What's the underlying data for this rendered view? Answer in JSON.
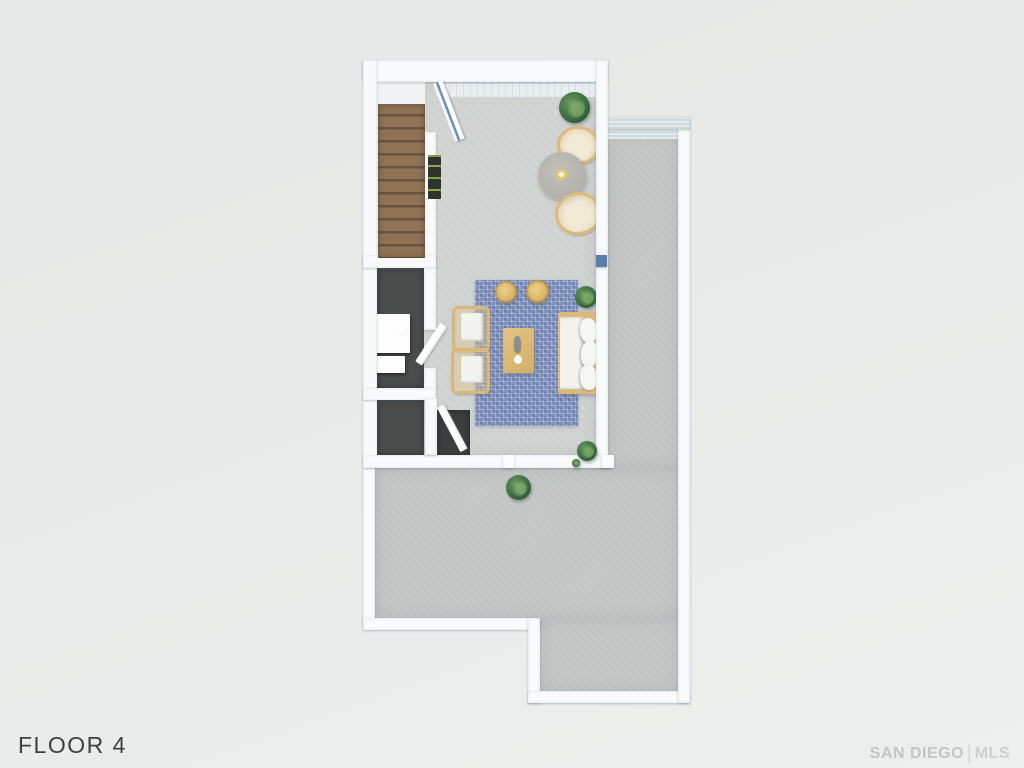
{
  "page": {
    "kind": "3d-rendered-floor-plan-listing-image",
    "background": "#e9ebea",
    "width": 1024,
    "height": 768
  },
  "labels": {
    "floor": "FLOOR 4",
    "watermark_left": "SAN DIEGO",
    "watermark_sep": "|",
    "watermark_right": "MLS"
  },
  "palette": {
    "background": "#e9ebea",
    "wall": "#f8fafb",
    "wall_shadow": "#cfd9de",
    "deck_floor": "#c6c8c7",
    "interior_floor": "#d2d4d3",
    "dark_room_floor": "#4b4d4d",
    "stairs_wood": "#8e7356",
    "rug_blue": "#7d90bd",
    "rattan_tan": "#dcba7c",
    "sofa_cushion": "#f2f2ef",
    "plant_green": "#3c6c41",
    "label_text": "#3f4040",
    "watermark_text": "#c3c5c4"
  },
  "floor_plan": {
    "floor_name": "FLOOR 4",
    "rooms": [
      {
        "name": "stairwell",
        "feature": "wood staircase"
      },
      {
        "name": "living-dining-room",
        "feature": "open interior with concrete floor"
      },
      {
        "name": "powder-room",
        "feature": "dark floor, white fixture"
      },
      {
        "name": "storage-closet",
        "feature": "dark floor"
      },
      {
        "name": "roof-deck",
        "feature": "L-shaped wrap-around terrace"
      }
    ],
    "furniture": [
      "staircase",
      "open-glass-door",
      "green-wall-shelf",
      "potted-plant-dining",
      "round-dining-table",
      "wicker-dining-chair-top",
      "wicker-dining-chair-bottom",
      "blue-mosaic-rug",
      "round-pouf-left",
      "round-pouf-right",
      "coffee-table",
      "vase-decor",
      "rattan-armchair-upper",
      "rattan-armchair-lower",
      "white-sofa",
      "plant-beside-sofa",
      "toilet-fixture",
      "plant-corner-interior",
      "plant-on-deck",
      "door-handle-deck"
    ]
  }
}
